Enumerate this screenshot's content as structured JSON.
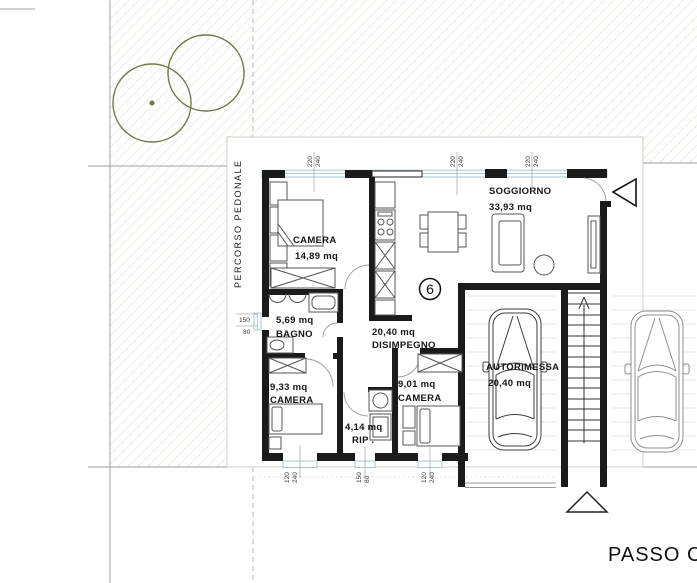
{
  "unit": {
    "number": "6"
  },
  "site": {
    "pedestrian_path_label": "PERCORSO PEDONALE",
    "driveway_label": "PASSO C"
  },
  "rooms": {
    "camera_matrimoniale": {
      "name": "CAMERA",
      "area": "14,89 mq"
    },
    "bagno": {
      "name": "BAGNO",
      "area": "5,69 mq"
    },
    "disimpegno": {
      "name": "DISIMPEGNO",
      "area": "20,40 mq"
    },
    "soggiorno": {
      "name": "SOGGIORNO",
      "area": "33,93 mq"
    },
    "camera_2": {
      "name": "CAMERA",
      "area": "9,33 mq"
    },
    "ripostiglio": {
      "name": "RIP .",
      "area": "4,14 mq"
    },
    "camera_3": {
      "name": "CAMERA",
      "area": "9,01 mq"
    },
    "autorimessa": {
      "name": "AUTORIMESSA",
      "area": "20,40 mq"
    }
  },
  "dimensions": {
    "top_windows": [
      {
        "w": "220",
        "h": "240"
      },
      {
        "w": "220",
        "h": "240"
      },
      {
        "w": "220",
        "h": "240"
      }
    ],
    "bottom_windows": [
      {
        "w": "120",
        "h": "240"
      },
      {
        "w": "150",
        "h": "80"
      },
      {
        "w": "120",
        "h": "240"
      }
    ],
    "left_window": {
      "w": "150",
      "h": "80"
    }
  },
  "colors": {
    "wall": "#1b1b1b",
    "window": "#a9c8d2",
    "tree": "#6f7747",
    "hatch": "#e3e2d7",
    "site_line": "#9f9f9f",
    "car_dark": "#3d3d3d",
    "car_light": "#8f8f8f"
  }
}
